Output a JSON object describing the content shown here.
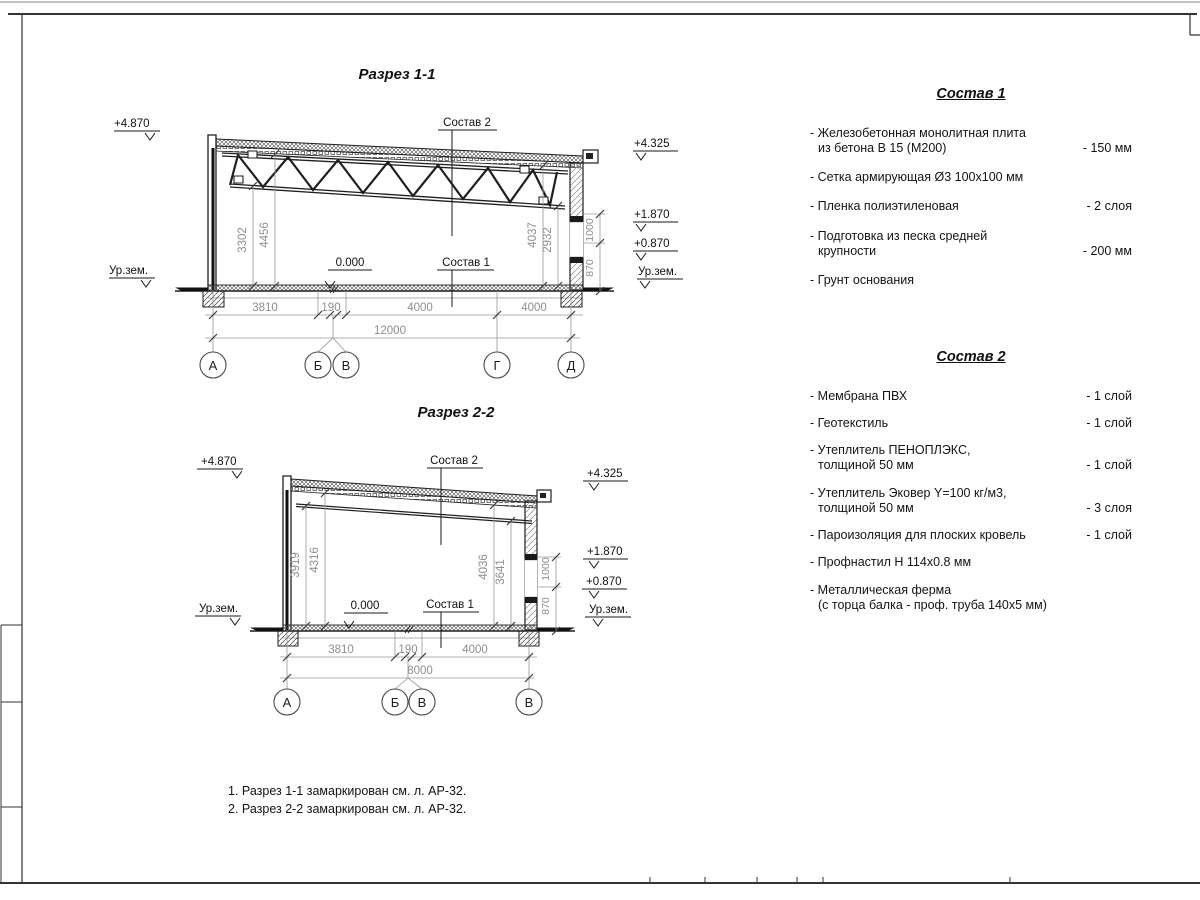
{
  "titles": {
    "s1": "Разрез 1-1",
    "s2": "Разрез 2-2"
  },
  "labels": {
    "sostav1": "Состав 1",
    "sostav2": "Состав 2",
    "zero": "0.000",
    "ground": "Ур.зем."
  },
  "elevations": {
    "top": "+4.870",
    "roof_right": "+4.325",
    "e1870": "+1.870",
    "e0870": "+0.870"
  },
  "section1": {
    "dims": [
      "3810",
      "190",
      "4000",
      "4000"
    ],
    "total": "12000",
    "vdims": [
      "3302",
      "4456",
      "4037",
      "2932"
    ],
    "wall_dims": [
      "870",
      "1000"
    ],
    "axes": [
      "А",
      "Б",
      "В",
      "Г",
      "Д"
    ]
  },
  "section2": {
    "dims": [
      "3810",
      "190",
      "4000"
    ],
    "total": "8000",
    "vdims": [
      "3919",
      "4316",
      "4036",
      "3641"
    ],
    "wall_dims": [
      "870",
      "1000"
    ],
    "axes": [
      "А",
      "Б",
      "В",
      "В"
    ]
  },
  "sostav1": {
    "title": "Состав 1",
    "items": [
      {
        "name": "- Железобетонная  монолитная плита\nиз бетона В 15 (М200)",
        "value": "- 150 мм"
      },
      {
        "name": "- Сетка армирующая Ø3 100x100 мм",
        "value": ""
      },
      {
        "name": "- Пленка полиэтиленовая",
        "value": "-  2 слоя"
      },
      {
        "name": "- Подготовка из песка средней\nкрупности",
        "value": "- 200 мм"
      },
      {
        "name": "- Грунт основания",
        "value": ""
      }
    ]
  },
  "sostav2": {
    "title": "Состав 2",
    "items": [
      {
        "name": "- Мембрана ПВХ",
        "value": "- 1 слой"
      },
      {
        "name": "- Геотекстиль",
        "value": "- 1 слой"
      },
      {
        "name": "- Утеплитель ПЕНОПЛЭКС,\nтолщиной 50 мм",
        "value": "- 1 слой"
      },
      {
        "name": "- Утеплитель Эковер Y=100 кг/м3,\nтолщиной 50 мм",
        "value": "- 3 слоя"
      },
      {
        "name": "- Пароизоляция для плоских кровель",
        "value": "- 1 слой"
      },
      {
        "name": "- Профнастил Н 114x0.8 мм",
        "value": ""
      },
      {
        "name": "- Металлическая ферма\n(с торца балка - проф. труба 140x5 мм)",
        "value": ""
      }
    ]
  },
  "notes": {
    "line1": "1. Разрез 1-1 замаркирован см. л. АР-32.",
    "line2": "2. Разрез 2-2 замаркирован см. л. АР-32."
  }
}
